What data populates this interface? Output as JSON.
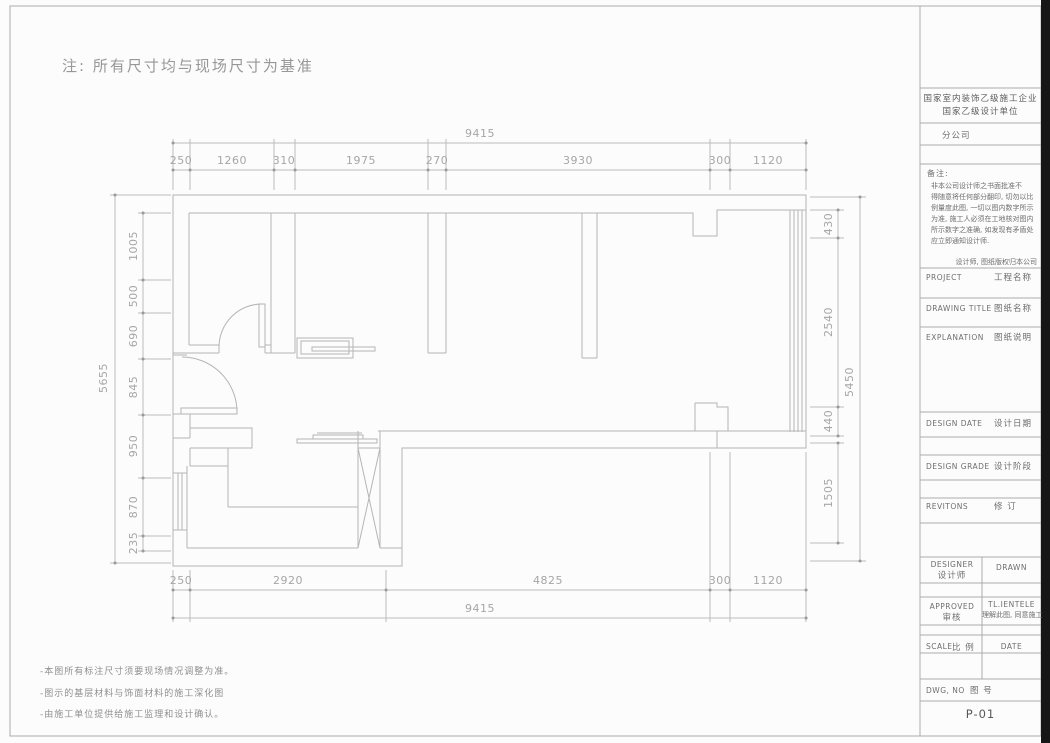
{
  "note_top": "注: 所有尺寸均与现场尺寸为基准",
  "dims": {
    "top": {
      "overall": "9415",
      "segments": [
        "250",
        "1260",
        "310",
        "1975",
        "270",
        "3930",
        "300",
        "1120"
      ]
    },
    "bottom": {
      "overall": "9415",
      "segments": [
        "250",
        "2920",
        "4825",
        "300",
        "1120"
      ]
    },
    "left": {
      "overall": "5655",
      "segments": [
        "1005",
        "500",
        "690",
        "845",
        "950",
        "870",
        "235"
      ]
    },
    "right": {
      "overall": "5450",
      "segments": [
        "430",
        "2540",
        "440",
        "1505"
      ]
    }
  },
  "footer_notes": [
    "-本图所有标注尺寸须要现场情况调整为准。",
    "-图示的基层材料与饰面材料的施工深化图",
    "-由施工单位提供给施工监理和设计确认。"
  ],
  "title_block": {
    "company_line1": "国家室内装饰乙级施工企业",
    "company_line2": "国家乙级设计单位",
    "branch": "分公司",
    "remarks_label": "备注:",
    "remarks_lines": [
      "非本公司设计师之书面批准不",
      "得随意将任何部分翻印, 切勿以比",
      "例量度此图, 一切以图内数字所示",
      "为准, 施工人必须在工地核对图内",
      "所示数字之准确, 如发现有矛盾处",
      "应立即通知设计师."
    ],
    "copyright": "设计师, 图纸版权归本公司",
    "project_en": "PROJECT",
    "project_cn": "工程名称",
    "drawing_title_en": "DRAWING TITLE",
    "drawing_title_cn": "图纸名称",
    "explanation_en": "EXPLANATION",
    "explanation_cn": "图纸说明",
    "design_date_en": "DESIGN DATE",
    "design_date_cn": "设计日期",
    "design_grade_en": "DESIGN GRADE",
    "design_grade_cn": "设计阶段",
    "revisions_en": "REVITONS",
    "revisions_cn": "修  订",
    "designer_en": "DESIGNER",
    "designer_cn": "设计师",
    "drawn_en": "DRAWN",
    "approved_en": "APPROVED",
    "approved_cn": "审核",
    "clientele_line1": "TL.IENTELE",
    "clientele_line2": "理解此图, 同意施工",
    "scale_en": "SCALE",
    "scale_cn": "比 例",
    "date_en": "DATE",
    "dwg_en": "DWG, NO",
    "dwg_cn": "图 号",
    "sheet_no": "P-01"
  },
  "colors": {
    "plan_line": "#b5b5b5",
    "dim_text": "#a6a6a6",
    "title_text": "#6e6e6e",
    "edge_band": "#161616"
  }
}
